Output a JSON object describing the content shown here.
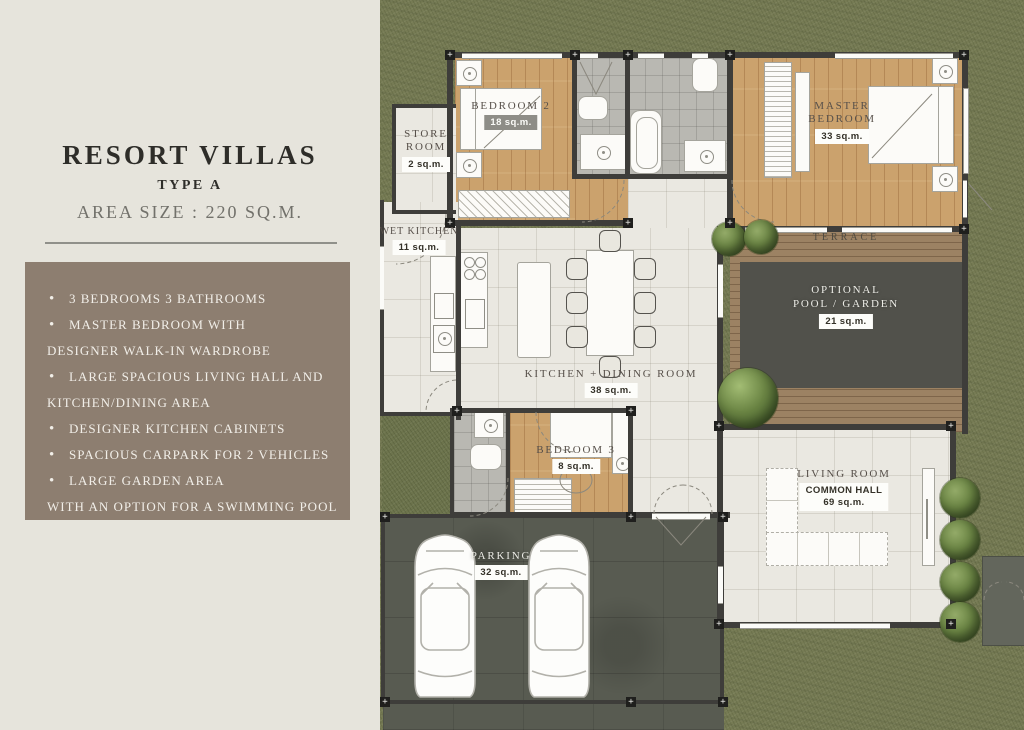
{
  "left_panel": {
    "title": "RESORT VILLAS",
    "subtitle": "TYPE A",
    "area_line": "AREA SIZE : 220 SQ.M.",
    "features": [
      {
        "bullet": true,
        "text": "3 BEDROOMS 3 BATHROOMS"
      },
      {
        "bullet": true,
        "text": "MASTER BEDROOM WITH"
      },
      {
        "bullet": false,
        "text": "DESIGNER WALK-IN WARDROBE"
      },
      {
        "bullet": true,
        "text": "LARGE SPACIOUS LIVING HALL AND"
      },
      {
        "bullet": false,
        "text": "KITCHEN/DINING AREA"
      },
      {
        "bullet": true,
        "text": "DESIGNER KITCHEN CABINETS"
      },
      {
        "bullet": true,
        "text": "SPACIOUS CARPARK FOR 2 VEHICLES"
      },
      {
        "bullet": true,
        "text": "LARGE GARDEN AREA"
      },
      {
        "bullet": false,
        "text": "WITH AN OPTION FOR A SWIMMING POOL"
      }
    ]
  },
  "floor_plan": {
    "rooms": {
      "bedroom2": {
        "name": "BEDROOM 2",
        "area": "18 sq.m."
      },
      "store": {
        "name": "STORE ROOM",
        "area": "2 sq.m."
      },
      "master": {
        "name": "MASTER BEDROOM",
        "area": "33 sq.m."
      },
      "wet_kitchen": {
        "name": "WET KITCHEN",
        "area": "11 sq.m."
      },
      "terrace": {
        "name": "TERRACE"
      },
      "pool": {
        "line1": "OPTIONAL",
        "line2": "POOL / GARDEN",
        "area": "21 sq.m."
      },
      "kitchen_dining": {
        "name": "KITCHEN + DINING ROOM",
        "area": "38 sq.m."
      },
      "bedroom3": {
        "name": "BEDROOM 3",
        "area": "8 sq.m."
      },
      "living": {
        "name": "LIVING ROOM",
        "sub": "COMMON HALL",
        "area": "69 sq.m."
      },
      "parking": {
        "name": "PARKING",
        "area": "32 sq.m."
      }
    },
    "colors": {
      "panel_bg": "#e6e4dc",
      "feature_box_bg": "#8d7e70",
      "title_text": "#2e2d29",
      "grass": "#767b54",
      "wood_floor": "#cba26d",
      "tile_floor": "#eae8e1",
      "bath_tile": "#b9b8b2",
      "deck_wood": "#9c8263",
      "concrete": "#585b51",
      "wall": "#3e3d3a",
      "pool_water": "#1e4b63"
    }
  }
}
